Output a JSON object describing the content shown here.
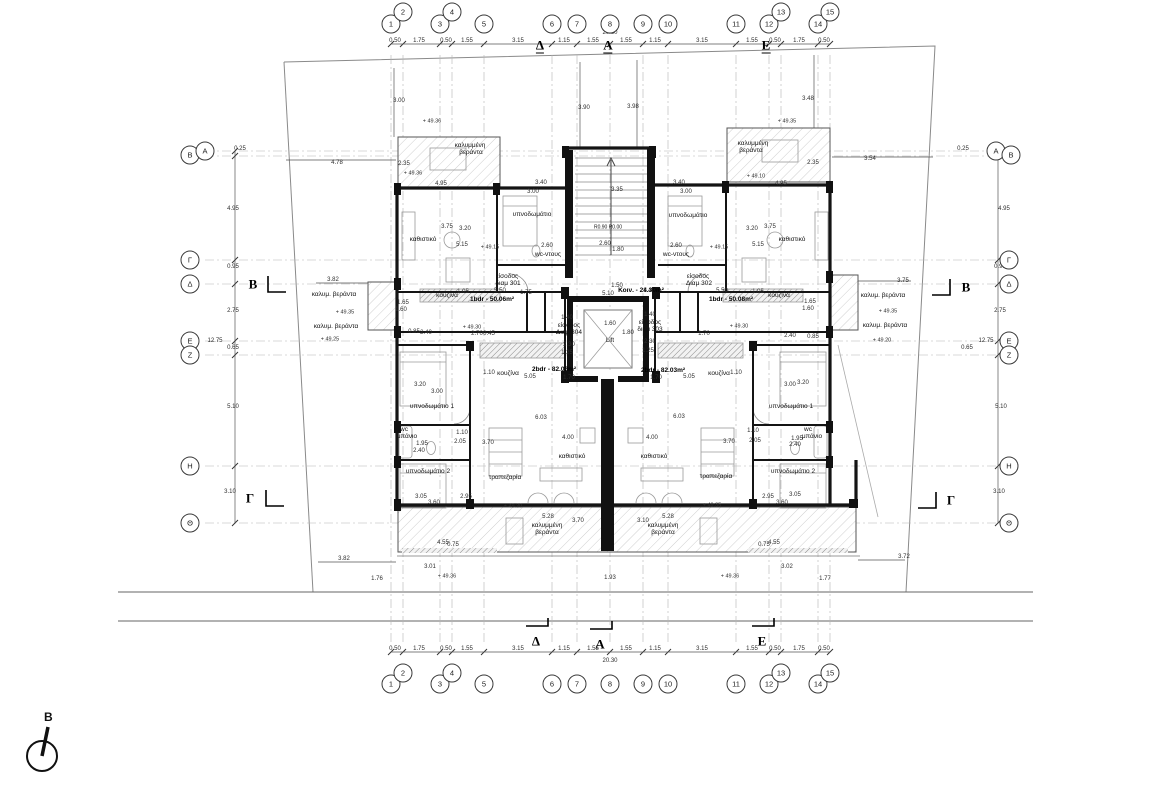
{
  "north": {
    "label": "Β"
  },
  "grid_lines": {
    "vertical": [
      391,
      403,
      440,
      452,
      484,
      552,
      577,
      610,
      643,
      668,
      736,
      769,
      781,
      818,
      830
    ],
    "horizontal": [
      151,
      156,
      260,
      284,
      341,
      355,
      466,
      523
    ]
  },
  "bubbles": [
    {
      "t": "1",
      "x": 391,
      "y": 24
    },
    {
      "t": "2",
      "x": 403,
      "y": 12
    },
    {
      "t": "3",
      "x": 440,
      "y": 24
    },
    {
      "t": "4",
      "x": 452,
      "y": 12
    },
    {
      "t": "5",
      "x": 484,
      "y": 24
    },
    {
      "t": "6",
      "x": 552,
      "y": 24
    },
    {
      "t": "7",
      "x": 577,
      "y": 24
    },
    {
      "t": "8",
      "x": 610,
      "y": 24
    },
    {
      "t": "9",
      "x": 643,
      "y": 24
    },
    {
      "t": "10",
      "x": 668,
      "y": 24
    },
    {
      "t": "11",
      "x": 736,
      "y": 24
    },
    {
      "t": "12",
      "x": 769,
      "y": 24
    },
    {
      "t": "13",
      "x": 781,
      "y": 12
    },
    {
      "t": "14",
      "x": 818,
      "y": 24
    },
    {
      "t": "15",
      "x": 830,
      "y": 12
    },
    {
      "t": "1",
      "x": 391,
      "y": 684
    },
    {
      "t": "2",
      "x": 403,
      "y": 673
    },
    {
      "t": "3",
      "x": 440,
      "y": 684
    },
    {
      "t": "4",
      "x": 452,
      "y": 673
    },
    {
      "t": "5",
      "x": 484,
      "y": 684
    },
    {
      "t": "6",
      "x": 552,
      "y": 684
    },
    {
      "t": "7",
      "x": 577,
      "y": 684
    },
    {
      "t": "8",
      "x": 610,
      "y": 684
    },
    {
      "t": "9",
      "x": 643,
      "y": 684
    },
    {
      "t": "10",
      "x": 668,
      "y": 684
    },
    {
      "t": "11",
      "x": 736,
      "y": 684
    },
    {
      "t": "12",
      "x": 769,
      "y": 684
    },
    {
      "t": "13",
      "x": 781,
      "y": 673
    },
    {
      "t": "14",
      "x": 818,
      "y": 684
    },
    {
      "t": "15",
      "x": 830,
      "y": 673
    },
    {
      "t": "Β",
      "x": 190,
      "y": 155
    },
    {
      "t": "Α",
      "x": 205,
      "y": 151
    },
    {
      "t": "Γ",
      "x": 190,
      "y": 260
    },
    {
      "t": "Δ",
      "x": 190,
      "y": 284
    },
    {
      "t": "Ε",
      "x": 190,
      "y": 341
    },
    {
      "t": "Ζ",
      "x": 190,
      "y": 355
    },
    {
      "t": "Η",
      "x": 190,
      "y": 466
    },
    {
      "t": "Θ",
      "x": 190,
      "y": 523
    },
    {
      "t": "Α",
      "x": 996,
      "y": 151
    },
    {
      "t": "Β",
      "x": 1011,
      "y": 155
    },
    {
      "t": "Γ",
      "x": 1009,
      "y": 260
    },
    {
      "t": "Δ",
      "x": 1009,
      "y": 284
    },
    {
      "t": "Ε",
      "x": 1009,
      "y": 341
    },
    {
      "t": "Ζ",
      "x": 1009,
      "y": 355
    },
    {
      "t": "Η",
      "x": 1009,
      "y": 466
    },
    {
      "t": "Θ",
      "x": 1009,
      "y": 523
    }
  ],
  "plan_labels": {
    "sections": [
      {
        "t": "Δ",
        "x": 540,
        "y": 46,
        "u": 1
      },
      {
        "t": "Α",
        "x": 608,
        "y": 46,
        "u": 1
      },
      {
        "t": "Ε",
        "x": 766,
        "y": 46,
        "u": 1
      },
      {
        "t": "Δ",
        "x": 536,
        "y": 641
      },
      {
        "t": "Α",
        "x": 600,
        "y": 644
      },
      {
        "t": "Ε",
        "x": 762,
        "y": 641
      },
      {
        "t": "Β",
        "x": 253,
        "y": 284
      },
      {
        "t": "Γ",
        "x": 250,
        "y": 498
      },
      {
        "t": "Β",
        "x": 966,
        "y": 287
      },
      {
        "t": "Γ",
        "x": 951,
        "y": 500
      }
    ],
    "dims": [
      {
        "t": "0.50",
        "x": 395,
        "y": 41
      },
      {
        "t": "1.75",
        "x": 419,
        "y": 41
      },
      {
        "t": "0.50",
        "x": 446,
        "y": 41
      },
      {
        "t": "1.55",
        "x": 467,
        "y": 41
      },
      {
        "t": "3.15",
        "x": 518,
        "y": 41
      },
      {
        "t": "1.15",
        "x": 564,
        "y": 41
      },
      {
        "t": "1.55",
        "x": 593,
        "y": 41
      },
      {
        "t": "1.55",
        "x": 626,
        "y": 41
      },
      {
        "t": "1.15",
        "x": 655,
        "y": 41
      },
      {
        "t": "3.15",
        "x": 702,
        "y": 41
      },
      {
        "t": "1.55",
        "x": 752,
        "y": 41
      },
      {
        "t": "0.50",
        "x": 775,
        "y": 41
      },
      {
        "t": "1.75",
        "x": 799,
        "y": 41
      },
      {
        "t": "0.50",
        "x": 824,
        "y": 41
      },
      {
        "t": "20.30",
        "x": 610,
        "y": 33
      },
      {
        "t": "0.50",
        "x": 395,
        "y": 649
      },
      {
        "t": "1.75",
        "x": 419,
        "y": 649
      },
      {
        "t": "0.50",
        "x": 446,
        "y": 649
      },
      {
        "t": "1.55",
        "x": 467,
        "y": 649
      },
      {
        "t": "3.15",
        "x": 518,
        "y": 649
      },
      {
        "t": "1.15",
        "x": 564,
        "y": 649
      },
      {
        "t": "1.55",
        "x": 593,
        "y": 649
      },
      {
        "t": "1.55",
        "x": 626,
        "y": 649
      },
      {
        "t": "1.15",
        "x": 655,
        "y": 649
      },
      {
        "t": "3.15",
        "x": 702,
        "y": 649
      },
      {
        "t": "1.55",
        "x": 752,
        "y": 649
      },
      {
        "t": "0.50",
        "x": 775,
        "y": 649
      },
      {
        "t": "1.75",
        "x": 799,
        "y": 649
      },
      {
        "t": "0.50",
        "x": 824,
        "y": 649
      },
      {
        "t": "20.30",
        "x": 610,
        "y": 661
      },
      {
        "t": "0.25",
        "x": 240,
        "y": 149
      },
      {
        "t": "4.95",
        "x": 233,
        "y": 209
      },
      {
        "t": "0.95",
        "x": 233,
        "y": 267
      },
      {
        "t": "2.75",
        "x": 233,
        "y": 311
      },
      {
        "t": "12.75",
        "x": 215,
        "y": 341
      },
      {
        "t": "0.65",
        "x": 233,
        "y": 348
      },
      {
        "t": "5.10",
        "x": 233,
        "y": 407
      },
      {
        "t": "3.10",
        "x": 230,
        "y": 492
      },
      {
        "t": "0.25",
        "x": 963,
        "y": 149
      },
      {
        "t": "4.95",
        "x": 1004,
        "y": 209
      },
      {
        "t": "0.95",
        "x": 1000,
        "y": 267
      },
      {
        "t": "2.75",
        "x": 1000,
        "y": 311
      },
      {
        "t": "12.75",
        "x": 986,
        "y": 341
      },
      {
        "t": "0.65",
        "x": 967,
        "y": 348
      },
      {
        "t": "5.10",
        "x": 1001,
        "y": 407
      },
      {
        "t": "3.10",
        "x": 999,
        "y": 492
      },
      {
        "t": "4.78",
        "x": 337,
        "y": 163
      },
      {
        "t": "2.35",
        "x": 404,
        "y": 164
      },
      {
        "t": "2.35",
        "x": 813,
        "y": 163
      },
      {
        "t": "3.54",
        "x": 870,
        "y": 159
      },
      {
        "t": "3.82",
        "x": 333,
        "y": 280
      },
      {
        "t": "3.75",
        "x": 903,
        "y": 281
      },
      {
        "t": "3.82",
        "x": 344,
        "y": 559
      },
      {
        "t": "3.72",
        "x": 904,
        "y": 557
      },
      {
        "t": "3.01",
        "x": 430,
        "y": 567
      },
      {
        "t": "3.02",
        "x": 787,
        "y": 567
      },
      {
        "t": "1.76",
        "x": 377,
        "y": 579
      },
      {
        "t": "1.77",
        "x": 825,
        "y": 579
      },
      {
        "t": "1.93",
        "x": 610,
        "y": 578
      },
      {
        "t": "3.00",
        "x": 399,
        "y": 101
      },
      {
        "t": "3.90",
        "x": 584,
        "y": 108
      },
      {
        "t": "3.98",
        "x": 633,
        "y": 107
      },
      {
        "t": "3.48",
        "x": 808,
        "y": 99
      },
      {
        "t": "4.95",
        "x": 441,
        "y": 184
      },
      {
        "t": "4.95",
        "x": 781,
        "y": 184
      },
      {
        "t": "3.40",
        "x": 541,
        "y": 183
      },
      {
        "t": "3.00",
        "x": 533,
        "y": 192
      },
      {
        "t": "3.75",
        "x": 447,
        "y": 227
      },
      {
        "t": "3.20",
        "x": 465,
        "y": 229
      },
      {
        "t": "5.15",
        "x": 462,
        "y": 245
      },
      {
        "t": "2.60",
        "x": 547,
        "y": 246
      },
      {
        "t": "1.75",
        "x": 526,
        "y": 293
      },
      {
        "t": "5.50",
        "x": 500,
        "y": 291
      },
      {
        "t": "1.05",
        "x": 463,
        "y": 292
      },
      {
        "t": "1.65",
        "x": 403,
        "y": 303
      },
      {
        "t": "1.60",
        "x": 401,
        "y": 310
      },
      {
        "t": "0.85",
        "x": 414,
        "y": 332
      },
      {
        "t": "2.40",
        "x": 426,
        "y": 333
      },
      {
        "t": "2.70",
        "x": 477,
        "y": 334
      },
      {
        "t": "0.45",
        "x": 489,
        "y": 334
      },
      {
        "t": "3.40",
        "x": 679,
        "y": 183
      },
      {
        "t": "3.00",
        "x": 686,
        "y": 192
      },
      {
        "t": "3.20",
        "x": 752,
        "y": 229
      },
      {
        "t": "3.75",
        "x": 770,
        "y": 227
      },
      {
        "t": "5.15",
        "x": 758,
        "y": 245
      },
      {
        "t": "2.60",
        "x": 676,
        "y": 246
      },
      {
        "t": "1.40",
        "x": 649,
        "y": 291
      },
      {
        "t": "5.50",
        "x": 722,
        "y": 291
      },
      {
        "t": "1.05",
        "x": 758,
        "y": 292
      },
      {
        "t": "1.65",
        "x": 810,
        "y": 302
      },
      {
        "t": "1.60",
        "x": 808,
        "y": 309
      },
      {
        "t": "2.40",
        "x": 790,
        "y": 336
      },
      {
        "t": "0.85",
        "x": 813,
        "y": 337
      },
      {
        "t": "1.70",
        "x": 704,
        "y": 334
      },
      {
        "t": "1.40",
        "x": 567,
        "y": 318
      },
      {
        "t": "2.30",
        "x": 569,
        "y": 345
      },
      {
        "t": "1.25",
        "x": 567,
        "y": 353
      },
      {
        "t": "1.40",
        "x": 650,
        "y": 315
      },
      {
        "t": "2.30",
        "x": 650,
        "y": 342
      },
      {
        "t": "1.25",
        "x": 648,
        "y": 351
      },
      {
        "t": "1.60",
        "x": 610,
        "y": 324
      },
      {
        "t": "1.80",
        "x": 628,
        "y": 333
      },
      {
        "t": "5.10",
        "x": 608,
        "y": 294
      },
      {
        "t": "1.50",
        "x": 617,
        "y": 286
      },
      {
        "t": "3.35",
        "x": 617,
        "y": 190
      },
      {
        "t": "2.60",
        "x": 605,
        "y": 244
      },
      {
        "t": "1.80",
        "x": 618,
        "y": 250
      },
      {
        "t": "3.20",
        "x": 420,
        "y": 385
      },
      {
        "t": "3.00",
        "x": 437,
        "y": 392
      },
      {
        "t": "1.95",
        "x": 422,
        "y": 444
      },
      {
        "t": "2.40",
        "x": 419,
        "y": 451
      },
      {
        "t": "3.05",
        "x": 421,
        "y": 497
      },
      {
        "t": "2.95",
        "x": 466,
        "y": 497
      },
      {
        "t": "3.60",
        "x": 434,
        "y": 503
      },
      {
        "t": "1.10",
        "x": 462,
        "y": 433
      },
      {
        "t": "2.05",
        "x": 460,
        "y": 442
      },
      {
        "t": "3.70",
        "x": 488,
        "y": 443
      },
      {
        "t": "6.03",
        "x": 541,
        "y": 418
      },
      {
        "t": "4.00",
        "x": 568,
        "y": 438
      },
      {
        "t": "1.10",
        "x": 489,
        "y": 373
      },
      {
        "t": "5.05",
        "x": 530,
        "y": 377
      },
      {
        "t": "1.70",
        "x": 569,
        "y": 378
      },
      {
        "t": "3.00",
        "x": 790,
        "y": 385
      },
      {
        "t": "3.20",
        "x": 803,
        "y": 383
      },
      {
        "t": "1.95",
        "x": 797,
        "y": 439
      },
      {
        "t": "2.40",
        "x": 795,
        "y": 445
      },
      {
        "t": "2.95",
        "x": 768,
        "y": 497
      },
      {
        "t": "3.05",
        "x": 795,
        "y": 495
      },
      {
        "t": "3.60",
        "x": 782,
        "y": 503
      },
      {
        "t": "1.10",
        "x": 753,
        "y": 431
      },
      {
        "t": "2.05",
        "x": 755,
        "y": 441
      },
      {
        "t": "3.70",
        "x": 729,
        "y": 442
      },
      {
        "t": "6.03",
        "x": 679,
        "y": 417
      },
      {
        "t": "4.00",
        "x": 652,
        "y": 438
      },
      {
        "t": "1.10",
        "x": 736,
        "y": 373
      },
      {
        "t": "5.05",
        "x": 689,
        "y": 377
      },
      {
        "t": "1.70",
        "x": 656,
        "y": 378
      },
      {
        "t": "5.28",
        "x": 548,
        "y": 517
      },
      {
        "t": "3.70",
        "x": 578,
        "y": 521
      },
      {
        "t": "3.10",
        "x": 643,
        "y": 521
      },
      {
        "t": "5.28",
        "x": 668,
        "y": 517
      },
      {
        "t": "4.55",
        "x": 443,
        "y": 543
      },
      {
        "t": "0.75",
        "x": 453,
        "y": 545
      },
      {
        "t": "0.75",
        "x": 764,
        "y": 545
      },
      {
        "t": "4.55",
        "x": 774,
        "y": 543
      }
    ],
    "levels": [
      {
        "t": "+ 49.36",
        "x": 432,
        "y": 122
      },
      {
        "t": "+ 49.35",
        "x": 787,
        "y": 122
      },
      {
        "t": "+ 49.36",
        "x": 413,
        "y": 174
      },
      {
        "t": "+ 49.10",
        "x": 756,
        "y": 177
      },
      {
        "t": "+ 49.15",
        "x": 490,
        "y": 248
      },
      {
        "t": "+ 49.15",
        "x": 719,
        "y": 248
      },
      {
        "t": "+ 49.35",
        "x": 345,
        "y": 313
      },
      {
        "t": "+ 49.25",
        "x": 330,
        "y": 340
      },
      {
        "t": "+ 49.30",
        "x": 472,
        "y": 328
      },
      {
        "t": "+ 49.30",
        "x": 739,
        "y": 327
      },
      {
        "t": "+ 49.35",
        "x": 888,
        "y": 312
      },
      {
        "t": "+ 49.20",
        "x": 882,
        "y": 341
      },
      {
        "t": "+ 49.30",
        "x": 513,
        "y": 507
      },
      {
        "t": "+ 49.35",
        "x": 712,
        "y": 506
      },
      {
        "t": "+ 49.36",
        "x": 447,
        "y": 577
      },
      {
        "t": "+ 49.36",
        "x": 730,
        "y": 577
      }
    ],
    "rooms": [
      {
        "t": "καλυμμένη",
        "x": 470,
        "y": 146
      },
      {
        "t": "βεράντα",
        "x": 471,
        "y": 153
      },
      {
        "t": "καλυμμένη",
        "x": 753,
        "y": 144
      },
      {
        "t": "βεράντα",
        "x": 751,
        "y": 151
      },
      {
        "t": "καθιστικό",
        "x": 423,
        "y": 240
      },
      {
        "t": "υπνοδωμάτιο",
        "x": 532,
        "y": 215
      },
      {
        "t": "wc-ντους",
        "x": 548,
        "y": 255
      },
      {
        "t": "wc-ντους",
        "x": 676,
        "y": 255
      },
      {
        "t": "υπνοδωμάτιο",
        "x": 688,
        "y": 216
      },
      {
        "t": "καθιστικό",
        "x": 792,
        "y": 240
      },
      {
        "t": "κουζίνα",
        "x": 447,
        "y": 296
      },
      {
        "t": "κουζίνα",
        "x": 779,
        "y": 296
      },
      {
        "t": "καλυμ. βεράντα",
        "x": 334,
        "y": 295
      },
      {
        "t": "καλυμ. βεράντα",
        "x": 336,
        "y": 327
      },
      {
        "t": "καλυμ. βεράντα",
        "x": 883,
        "y": 296
      },
      {
        "t": "καλυμ. βεράντα",
        "x": 885,
        "y": 326
      },
      {
        "t": "είσοδος",
        "x": 507,
        "y": 277
      },
      {
        "t": "διαμ 301",
        "x": 508,
        "y": 284
      },
      {
        "t": "είσοδος",
        "x": 698,
        "y": 277
      },
      {
        "t": "Διαμ 302",
        "x": 699,
        "y": 284
      },
      {
        "t": "είσοδος",
        "x": 569,
        "y": 326
      },
      {
        "t": "Διαμ 304",
        "x": 569,
        "y": 333
      },
      {
        "t": "είσοδος",
        "x": 650,
        "y": 323
      },
      {
        "t": "διαμ 303",
        "x": 650,
        "y": 330
      },
      {
        "t": "υπνοδωμάτιο 1",
        "x": 432,
        "y": 407
      },
      {
        "t": "wc",
        "x": 404,
        "y": 430
      },
      {
        "t": "μπάνιο",
        "x": 407,
        "y": 437
      },
      {
        "t": "υπνοδωμάτιο 2",
        "x": 428,
        "y": 472
      },
      {
        "t": "τραπεζαρία",
        "x": 505,
        "y": 478
      },
      {
        "t": "καθιστικό",
        "x": 572,
        "y": 457
      },
      {
        "t": "κουζίνα",
        "x": 508,
        "y": 374
      },
      {
        "t": "κουζίνα",
        "x": 719,
        "y": 374
      },
      {
        "t": "υπνοδωμάτιο 1",
        "x": 791,
        "y": 407
      },
      {
        "t": "wc",
        "x": 808,
        "y": 430
      },
      {
        "t": "μπάνιο",
        "x": 812,
        "y": 437
      },
      {
        "t": "υπνοδωμάτιο 2",
        "x": 793,
        "y": 472
      },
      {
        "t": "τραπεζαρία",
        "x": 716,
        "y": 477
      },
      {
        "t": "καθιστικό",
        "x": 654,
        "y": 457
      },
      {
        "t": "καλυμμένη",
        "x": 547,
        "y": 526
      },
      {
        "t": "βεράντα",
        "x": 547,
        "y": 533
      },
      {
        "t": "καλυμμένη",
        "x": 663,
        "y": 526
      },
      {
        "t": "βεράντα",
        "x": 663,
        "y": 533
      }
    ],
    "areas": [
      {
        "t": "1bdr - 50.06m²",
        "x": 492,
        "y": 300
      },
      {
        "t": "1bdr - 50.08m²",
        "x": 731,
        "y": 300
      },
      {
        "t": "2bdr - 82.03m²",
        "x": 554,
        "y": 370
      },
      {
        "t": "2bdr - 82.03m²",
        "x": 663,
        "y": 371
      },
      {
        "t": "Κοιν. - 24.39m²",
        "x": 641,
        "y": 291
      }
    ],
    "annotations": [
      {
        "t": "Lift",
        "x": 610,
        "y": 341
      },
      {
        "t": "R0.90 R0.00",
        "x": 608,
        "y": 228,
        "fs": 5
      }
    ]
  }
}
